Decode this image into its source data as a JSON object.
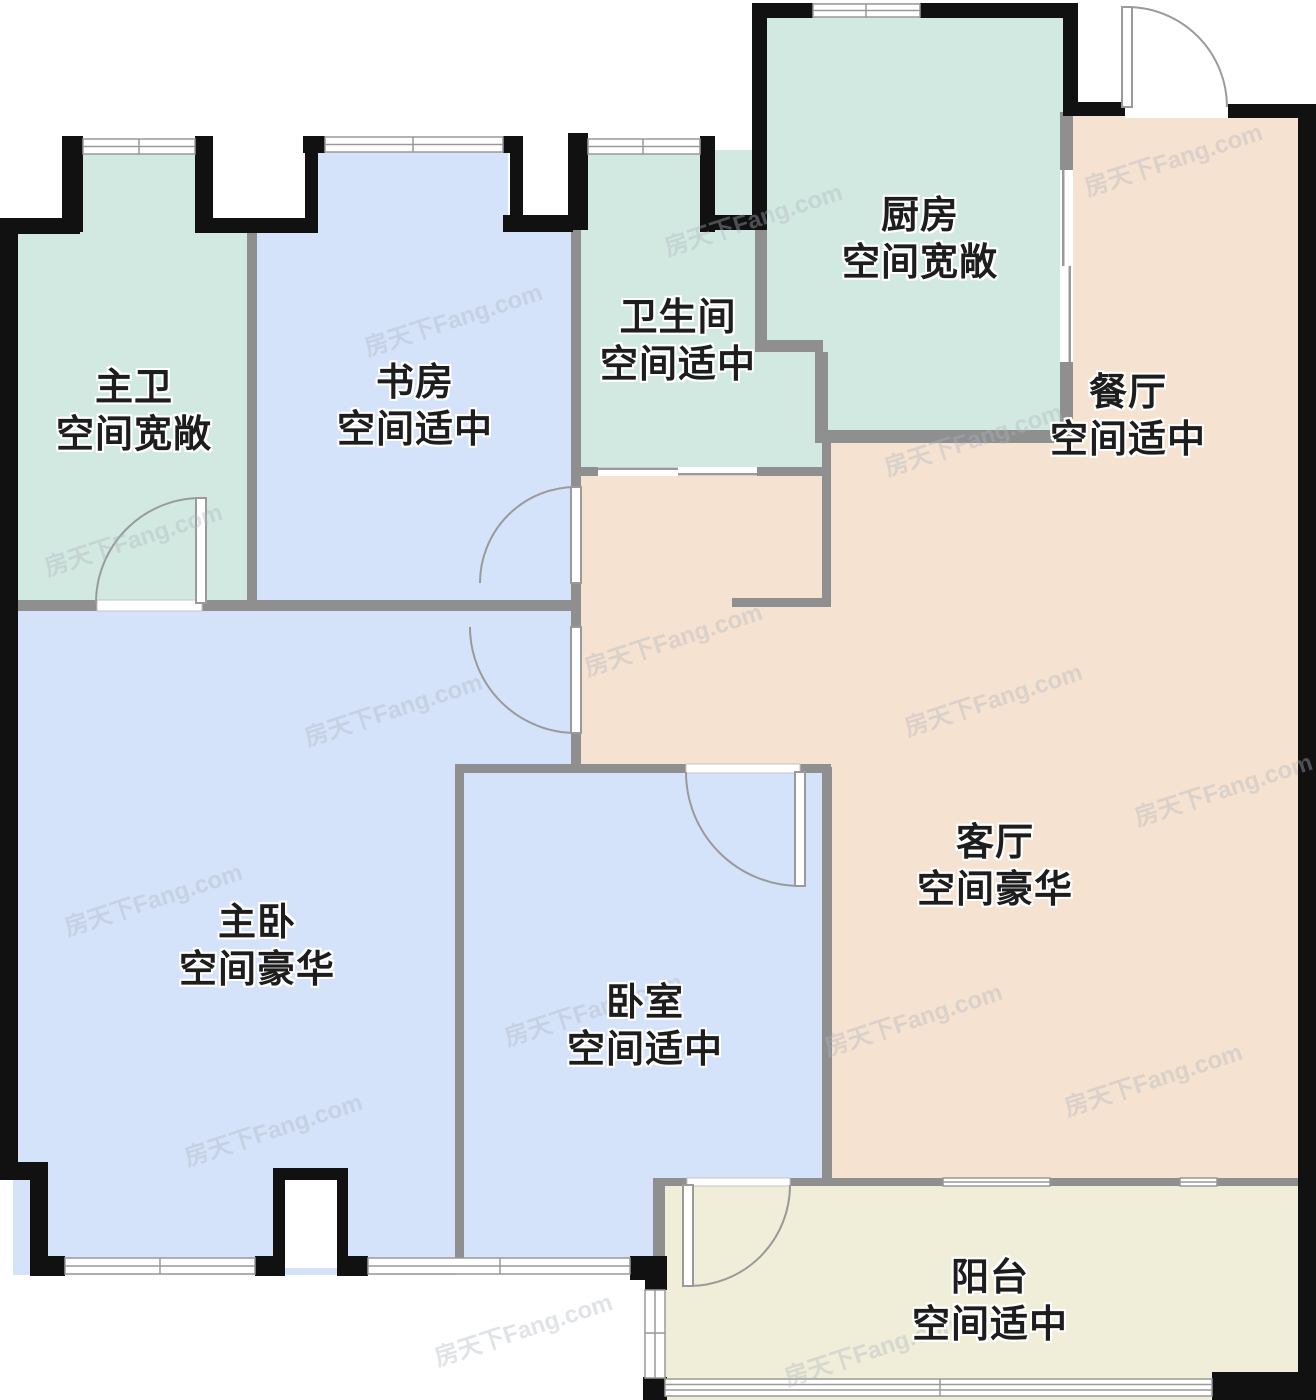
{
  "watermark": {
    "text": "房天下Fang.com"
  },
  "rooms": [
    {
      "id": "master-bath",
      "name": "主卫",
      "size_desc": "空间宽敞"
    },
    {
      "id": "study",
      "name": "书房",
      "size_desc": "空间适中"
    },
    {
      "id": "bathroom",
      "name": "卫生间",
      "size_desc": "空间适中"
    },
    {
      "id": "kitchen",
      "name": "厨房",
      "size_desc": "空间宽敞"
    },
    {
      "id": "dining",
      "name": "餐厅",
      "size_desc": "空间适中"
    },
    {
      "id": "living",
      "name": "客厅",
      "size_desc": "空间豪华"
    },
    {
      "id": "master-bedroom",
      "name": "主卧",
      "size_desc": "空间豪华"
    },
    {
      "id": "bedroom",
      "name": "卧室",
      "size_desc": "空间适中"
    },
    {
      "id": "balcony",
      "name": "阳台",
      "size_desc": "空间适中"
    }
  ],
  "colors": {
    "room_teal": "#d2e9e1",
    "room_blue": "#d5e3fa",
    "room_tan": "#f6e2d0",
    "room_yellow": "#f0eed8",
    "exterior_wall": "#111111",
    "interior_wall": "#8f8f8f",
    "door_arc": "#9a9a9a",
    "window_line": "#999999",
    "background": "#ffffff"
  }
}
